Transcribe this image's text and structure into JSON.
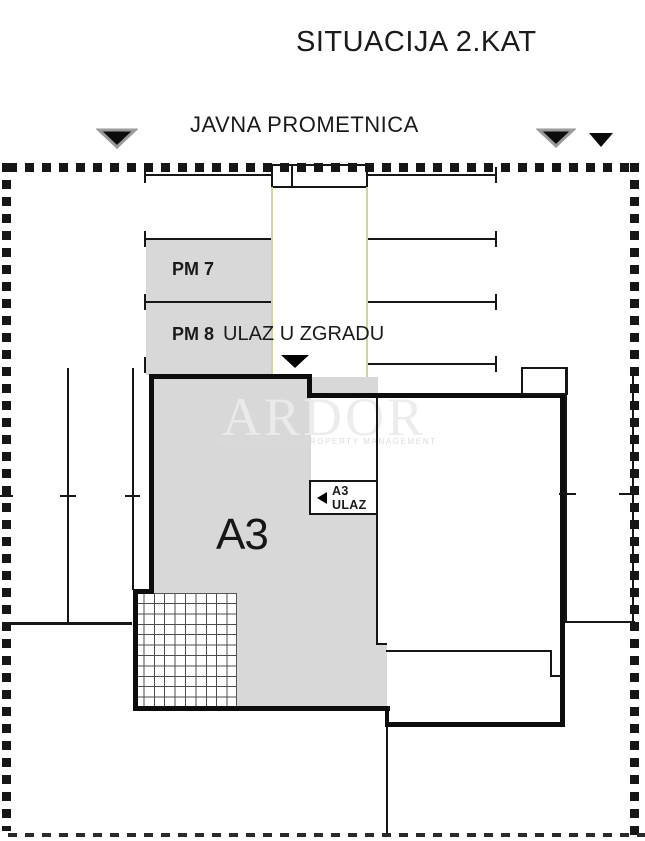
{
  "title": "SITUACIJA 2.KAT",
  "road": {
    "label": "JAVNA PROMETNICA"
  },
  "parking": {
    "pm7_label": "PM 7",
    "pm8_label": "PM 8",
    "building_entrance_label": "ULAZ U ZGRADU"
  },
  "building": {
    "apartment_label": "A3",
    "apartment_entrance_label": "A3 ULAZ"
  },
  "watermark": {
    "brand": "ARDOR",
    "tagline": "REAL ESTATE & PROPERTY MANAGEMENT"
  },
  "icons": {
    "road_arrows": "down-triangle",
    "building_entrance_arrow": "down-triangle",
    "apartment_entrance_arrow": "left-triangle"
  },
  "colors": {
    "fill_gray": "#d8d8d8",
    "path_green": "#ccd6a2",
    "line_black": "#161616"
  }
}
